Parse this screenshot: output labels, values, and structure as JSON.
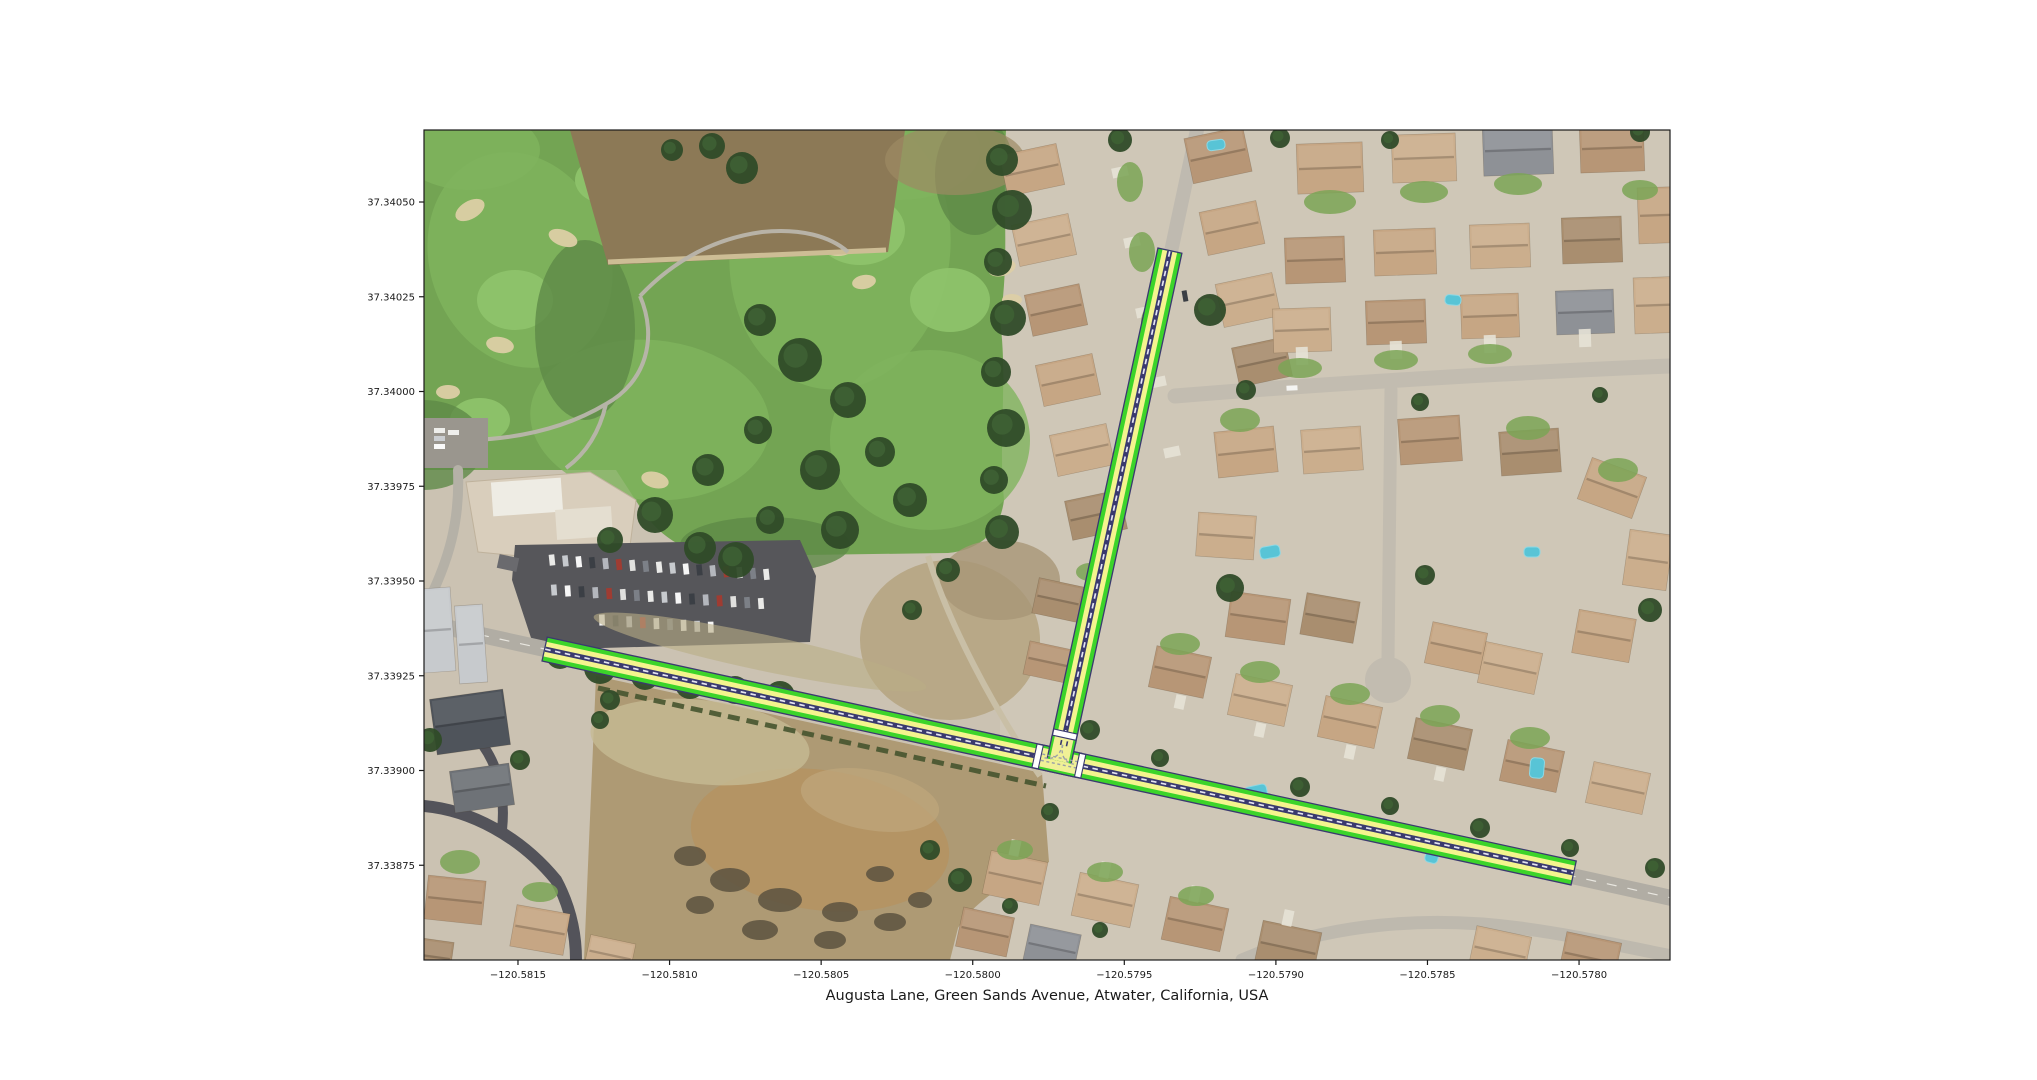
{
  "figure": {
    "background": "#ffffff",
    "xlabel": "Augusta Lane, Green Sands Avenue, Atwater, California, USA"
  },
  "axes": {
    "xlim": [
      -120.58181,
      -120.5777
    ],
    "ylim": [
      37.3385,
      37.34069
    ],
    "tick_color": "#1a1a1a",
    "frame_color": "#1a1a1a",
    "x_ticks": [
      {
        "value": -120.5815,
        "label": "−120.5815"
      },
      {
        "value": -120.581,
        "label": "−120.5810"
      },
      {
        "value": -120.5805,
        "label": "−120.5805"
      },
      {
        "value": -120.58,
        "label": "−120.5800"
      },
      {
        "value": -120.5795,
        "label": "−120.5795"
      },
      {
        "value": -120.579,
        "label": "−120.5790"
      },
      {
        "value": -120.5785,
        "label": "−120.5785"
      },
      {
        "value": -120.578,
        "label": "−120.5780"
      }
    ],
    "y_ticks": [
      {
        "value": 37.3405,
        "label": "37.34050"
      },
      {
        "value": 37.34025,
        "label": "37.34025"
      },
      {
        "value": 37.34,
        "label": "37.34000"
      },
      {
        "value": 37.33975,
        "label": "37.33975"
      },
      {
        "value": 37.3395,
        "label": "37.33950"
      },
      {
        "value": 37.33925,
        "label": "37.33925"
      },
      {
        "value": 37.339,
        "label": "37.33900"
      },
      {
        "value": 37.33875,
        "label": "37.33875"
      }
    ]
  },
  "map_overlay": {
    "colors": {
      "casing": "#3A3A6E",
      "edge_green": "#3CD42A",
      "lane_yellow": "#F4F48E",
      "center_line": "#3A3A6E",
      "center_dash": "#E4E4F2",
      "junction_fill": "#F0F096",
      "crosswalk": "#FFFFFF",
      "connector_dash": "#9BA0A8"
    },
    "edges": [
      {
        "name": "Green Sands Avenue",
        "from": [
          -120.58141,
          37.33932
        ],
        "to": [
          -120.57802,
          37.33873
        ]
      },
      {
        "name": "Augusta Lane",
        "from": [
          -120.57935,
          37.34037
        ],
        "to": [
          -120.5797,
          37.33908
        ]
      }
    ],
    "junction": {
      "name": "Augusta Lane / Green Sands Avenue",
      "center": [
        -120.5797,
        37.33902
      ]
    }
  }
}
